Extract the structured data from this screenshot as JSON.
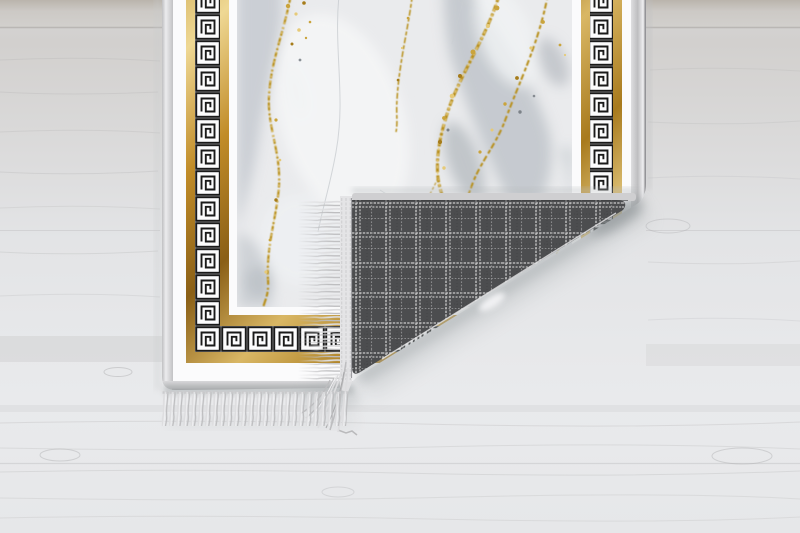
{
  "scene": {
    "subject": "rug-product-photo",
    "rug": {
      "field": "gray-gold-marble",
      "border": "greek-key-meander",
      "backing": "gray-plaid-weave",
      "edge": "fringed"
    }
  },
  "colors": {
    "floor_base": "#e7e8ea",
    "floor_plank_dark": "#c9c6c2",
    "floor_grain": "#b2b2b4",
    "rug_white": "#fbfbfc",
    "edge_binding": "#d6d6d8",
    "gold_light": "#efd894",
    "gold_mid": "#c18c28",
    "gold_dark": "#8a5f16",
    "key_black": "#1a1a1a",
    "key_background": "#fcfcfd",
    "marble_base": "#eaebed",
    "marble_gray": "#c2c7cc",
    "marble_gray_dark": "#aab0b6",
    "vein_gold": "#b8901f",
    "vein_gold_light": "#e8cc74",
    "plaid_base": "#4c4d4f",
    "plaid_line_bright": "#d2d2d2",
    "plaid_line_dim": "#98989a",
    "fringe_light": "#dddddf",
    "fringe_mid": "#bdbdbf",
    "shadow": "#8e9294"
  }
}
